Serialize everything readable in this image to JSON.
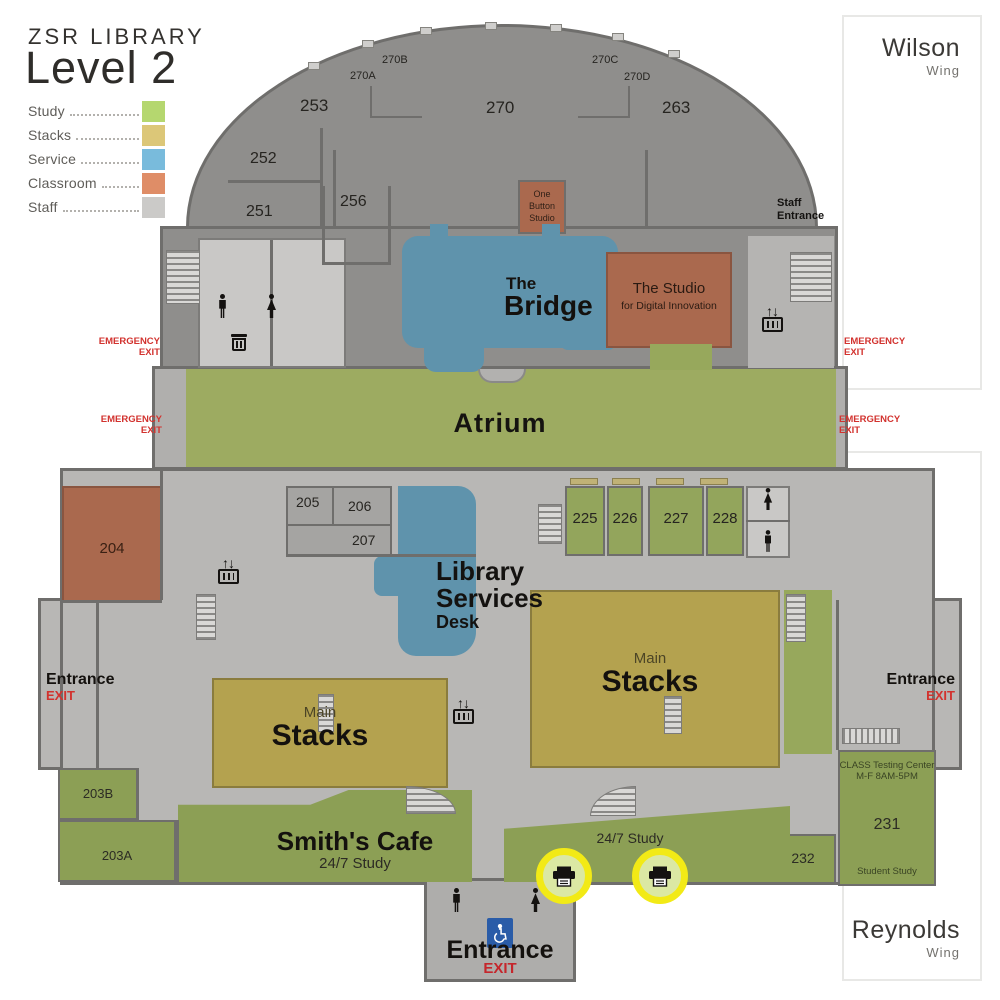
{
  "header": {
    "title": "ZSR LIBRARY",
    "subtitle": "Level 2"
  },
  "legend": {
    "items": [
      {
        "label": "Study",
        "color": "#b5d76f"
      },
      {
        "label": "Stacks",
        "color": "#dcc778"
      },
      {
        "label": "Service",
        "color": "#79bbdc"
      },
      {
        "label": "Classroom",
        "color": "#df8d67"
      },
      {
        "label": "Staff",
        "color": "#cbcac8"
      }
    ]
  },
  "wings": {
    "wilson": {
      "name": "Wilson",
      "sub": "Wing"
    },
    "reynolds": {
      "name": "Reynolds",
      "sub": "Wing"
    }
  },
  "rooms": {
    "r253": "253",
    "r252": "252",
    "r251": "251",
    "r256": "256",
    "r270": "270",
    "r270a": "270A",
    "r270b": "270B",
    "r270c": "270C",
    "r270d": "270D",
    "r263": "263",
    "r205": "205",
    "r206": "206",
    "r207": "207",
    "r225": "225",
    "r226": "226",
    "r227": "227",
    "r228": "228",
    "r204": "204",
    "r203a": "203A",
    "r203b": "203B",
    "r231": "231",
    "r232": "232"
  },
  "areas": {
    "one_button_studio": {
      "line1": "One",
      "line2": "Button",
      "line3": "Studio"
    },
    "bridge": {
      "line1": "The",
      "line2": "Bridge"
    },
    "studio": {
      "line1": "The Studio",
      "line2": "for Digital Innovation"
    },
    "atrium": "Atrium",
    "library_services": {
      "line1": "Library",
      "line2": "Services",
      "line3": "Desk"
    },
    "stacks": {
      "small": "Main",
      "big": "Stacks"
    },
    "cafe": {
      "name": "Smith's Cafe",
      "sub": "24/7 Study"
    },
    "study247": "24/7 Study",
    "testing_center": {
      "line1": "CLASS Testing Center",
      "line2": "M-F 8AM-5PM",
      "sub": "Student Study"
    }
  },
  "labels": {
    "entrance": "Entrance",
    "exit": "EXIT",
    "emergency_line1": "EMERGENCY",
    "emergency_line2": "EXIT",
    "staff_line1": "Staff",
    "staff_line2": "Entrance"
  },
  "icons": {
    "elevator_arrows": "↑↓"
  },
  "colors": {
    "study_map": "#93a55c",
    "stacks_map": "#b4a24f",
    "service_map": "#5f93ac",
    "classroom_map": "#aa694e",
    "emergency_red": "#d2322e",
    "printer_ring": "#f2ea16",
    "accessibility_blue": "#2a5ca8"
  }
}
